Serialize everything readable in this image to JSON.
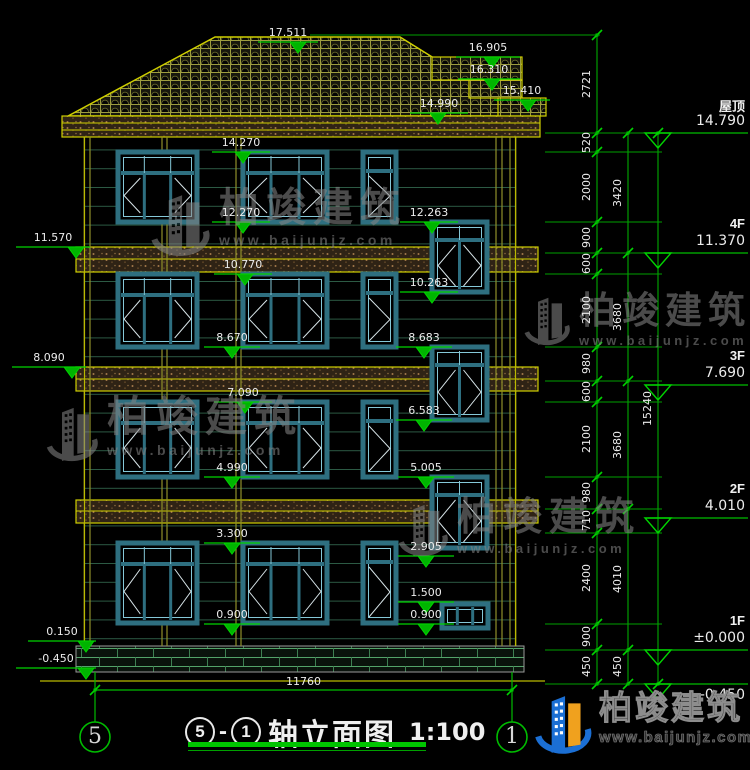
{
  "title": {
    "axis_a": "5",
    "dash": "-",
    "axis_b": "1",
    "text": "轴立面图",
    "scale": "1:100"
  },
  "watermark": {
    "brand": "柏竣建筑",
    "url": "www.baijunjz.com"
  },
  "footer_logo": {
    "brand": "柏竣建筑",
    "url": "www.baijunjz.com"
  },
  "axis_bubbles": {
    "left": "5",
    "right": "1"
  },
  "bottom_dim": {
    "value": "11760",
    "y": 690,
    "x1": 95,
    "x2": 512
  },
  "levels": [
    {
      "label": "屋顶",
      "value": "14.790",
      "y": 133
    },
    {
      "label": "4F",
      "value": "11.370",
      "y": 253
    },
    {
      "label": "3F",
      "value": "7.690",
      "y": 385
    },
    {
      "label": "2F",
      "value": "4.010",
      "y": 518
    },
    {
      "label": "1F",
      "value": "±0.000",
      "y": 650
    },
    {
      "label": "",
      "value": "-0.450",
      "y": 684,
      "below": true
    }
  ],
  "chains": [
    {
      "x": 597,
      "boundaries": [
        35,
        133,
        152,
        222,
        253,
        274,
        347,
        381,
        402,
        477,
        509,
        533,
        624,
        650,
        684
      ],
      "labels": [
        "2721",
        "520",
        "2000",
        "900",
        "600",
        "2100",
        "980",
        "600",
        "2100",
        "980",
        "710",
        "2400",
        "900",
        "450"
      ]
    },
    {
      "x": 628,
      "boundaries": [
        133,
        253,
        381,
        509,
        650,
        684
      ],
      "labels": [
        "3420",
        "3680",
        "3680",
        "4010",
        "450"
      ]
    },
    {
      "x": 658,
      "boundaries": [
        133,
        684
      ],
      "labels": [
        "15240"
      ]
    }
  ],
  "markers": [
    {
      "t": "17.511",
      "x1": 258,
      "x2": 318,
      "y": 42,
      "tx": 298
    },
    {
      "t": "16.905",
      "x1": 456,
      "x2": 520,
      "y": 57,
      "tx": 492
    },
    {
      "t": "16.310",
      "x1": 458,
      "x2": 520,
      "y": 79,
      "tx": 492
    },
    {
      "t": "15.410",
      "x1": 494,
      "x2": 550,
      "y": 100,
      "tx": 528
    },
    {
      "t": "14.990",
      "x1": 410,
      "x2": 468,
      "y": 113,
      "tx": 438
    },
    {
      "t": "14.270",
      "x1": 212,
      "x2": 270,
      "y": 152,
      "tx": 243
    },
    {
      "t": "12.270",
      "x1": 212,
      "x2": 270,
      "y": 222,
      "tx": 243
    },
    {
      "t": "12.263",
      "x1": 400,
      "x2": 458,
      "y": 222,
      "tx": 432
    },
    {
      "t": "11.570",
      "x1": 16,
      "x2": 90,
      "y": 247,
      "tx": 76
    },
    {
      "t": "10.770",
      "x1": 214,
      "x2": 272,
      "y": 274,
      "tx": 245
    },
    {
      "t": "10.263",
      "x1": 400,
      "x2": 458,
      "y": 292,
      "tx": 432
    },
    {
      "t": "8.670",
      "x1": 204,
      "x2": 260,
      "y": 347,
      "tx": 232
    },
    {
      "t": "8.683",
      "x1": 396,
      "x2": 452,
      "y": 347,
      "tx": 424
    },
    {
      "t": "8.090",
      "x1": 12,
      "x2": 86,
      "y": 367,
      "tx": 72
    },
    {
      "t": "7.090",
      "x1": 214,
      "x2": 272,
      "y": 402,
      "tx": 245
    },
    {
      "t": "6.583",
      "x1": 396,
      "x2": 452,
      "y": 420,
      "tx": 424
    },
    {
      "t": "4.990",
      "x1": 204,
      "x2": 260,
      "y": 477,
      "tx": 232
    },
    {
      "t": "5.005",
      "x1": 398,
      "x2": 454,
      "y": 477,
      "tx": 426
    },
    {
      "t": "3.300",
      "x1": 204,
      "x2": 260,
      "y": 543,
      "tx": 232
    },
    {
      "t": "2.905",
      "x1": 398,
      "x2": 454,
      "y": 556,
      "tx": 426
    },
    {
      "t": "1.500",
      "x1": 398,
      "x2": 454,
      "y": 602,
      "tx": 426
    },
    {
      "t": "0.900",
      "x1": 204,
      "x2": 260,
      "y": 624,
      "tx": 232
    },
    {
      "t": "0.900",
      "x1": 398,
      "x2": 454,
      "y": 624,
      "tx": 426
    },
    {
      "t": "0.150",
      "x1": 28,
      "x2": 96,
      "y": 641,
      "tx": 86
    },
    {
      "t": "-0.450",
      "x1": 16,
      "x2": 96,
      "y": 668,
      "tx": 86
    }
  ],
  "drawing": {
    "roof_main": "215,37 400,37 527,116 68,116",
    "roof_steps": [
      {
        "x": 432,
        "y": 57,
        "w": 90,
        "h": 23
      },
      {
        "x": 469,
        "y": 80,
        "w": 53,
        "h": 18
      },
      {
        "x": 498,
        "y": 98,
        "w": 48,
        "h": 18
      }
    ],
    "wall": {
      "x": 84,
      "y": 137,
      "w": 432,
      "h": 509
    },
    "eave_band": {
      "x": 62,
      "y": 116,
      "w": 478,
      "h": 21,
      "split": [
        7,
        14
      ]
    },
    "floor_bands": [
      {
        "x": 76,
        "y": 247,
        "w": 462,
        "h": 25,
        "split": [
          12
        ]
      },
      {
        "x": 76,
        "y": 367,
        "w": 462,
        "h": 24,
        "split": [
          12
        ]
      },
      {
        "x": 76,
        "y": 500,
        "w": 462,
        "h": 23,
        "split": [
          11
        ]
      }
    ],
    "plinth": {
      "x": 76,
      "y": 646,
      "w": 448,
      "h": 26
    },
    "verticals": [
      {
        "x": 84.5,
        "c": "#b9b900"
      },
      {
        "x": 90,
        "c": "#8f8f2a"
      },
      {
        "x": 162,
        "c": "#8f8f2a"
      },
      {
        "x": 167,
        "c": "#8f8f2a"
      },
      {
        "x": 236,
        "c": "#8f8f2a"
      },
      {
        "x": 241,
        "c": "#8f8f2a"
      },
      {
        "x": 496,
        "c": "#8f8f2a"
      },
      {
        "x": 502,
        "c": "#8f8f2a"
      },
      {
        "x": 510,
        "c": "#8f8f2a"
      },
      {
        "x": 515.5,
        "c": "#b9b900"
      }
    ],
    "windows": [
      {
        "x": 118,
        "y": 152,
        "w": 79,
        "h": 70,
        "type": "triple"
      },
      {
        "x": 243,
        "y": 152,
        "w": 84,
        "h": 70,
        "type": "triple"
      },
      {
        "x": 363,
        "y": 152,
        "w": 33,
        "h": 70,
        "type": "narrow"
      },
      {
        "x": 432,
        "y": 222,
        "w": 55,
        "h": 70,
        "type": "stair"
      },
      {
        "x": 118,
        "y": 274,
        "w": 79,
        "h": 73,
        "type": "triple"
      },
      {
        "x": 243,
        "y": 274,
        "w": 84,
        "h": 73,
        "type": "triple"
      },
      {
        "x": 363,
        "y": 274,
        "w": 33,
        "h": 73,
        "type": "narrow"
      },
      {
        "x": 432,
        "y": 347,
        "w": 55,
        "h": 73,
        "type": "stair"
      },
      {
        "x": 118,
        "y": 402,
        "w": 79,
        "h": 75,
        "type": "triple"
      },
      {
        "x": 243,
        "y": 402,
        "w": 84,
        "h": 75,
        "type": "triple"
      },
      {
        "x": 363,
        "y": 402,
        "w": 33,
        "h": 75,
        "type": "narrow"
      },
      {
        "x": 432,
        "y": 477,
        "w": 55,
        "h": 71,
        "type": "stair"
      },
      {
        "x": 118,
        "y": 543,
        "w": 79,
        "h": 80,
        "type": "triple"
      },
      {
        "x": 243,
        "y": 543,
        "w": 84,
        "h": 80,
        "type": "triple"
      },
      {
        "x": 363,
        "y": 543,
        "w": 33,
        "h": 80,
        "type": "narrow"
      },
      {
        "x": 442,
        "y": 604,
        "w": 46,
        "h": 24,
        "type": "low"
      }
    ],
    "ground_line": {
      "x1": 40,
      "x2": 545,
      "y": 681
    },
    "axis_circles": [
      {
        "cx": 95,
        "cy": 737,
        "r": 15
      },
      {
        "cx": 512,
        "cy": 737,
        "r": 15
      }
    ]
  }
}
